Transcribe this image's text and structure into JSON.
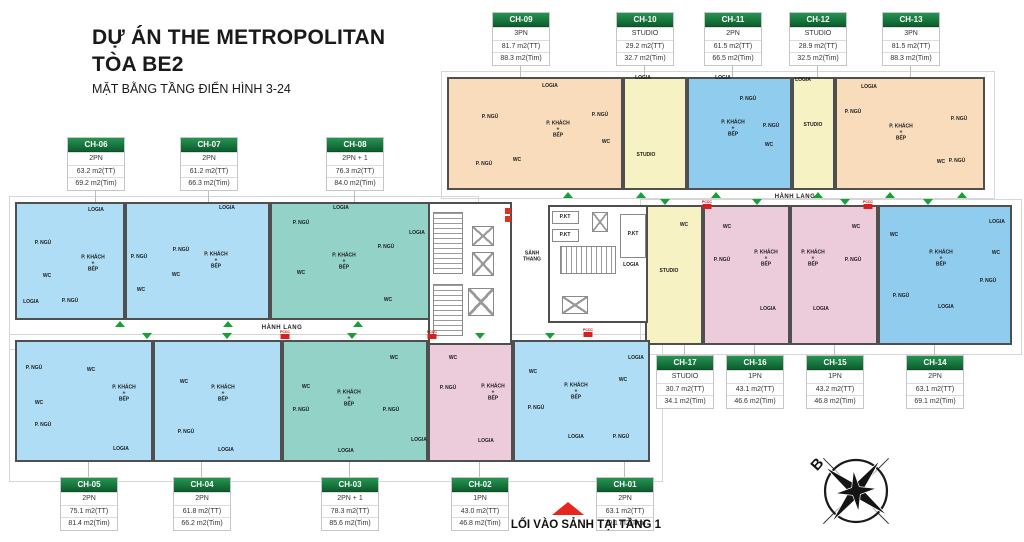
{
  "title": {
    "line1": "DỰ ÁN THE METROPOLITAN",
    "line2": "TÒA BE2",
    "subtitle": "MẶT BẰNG TẦNG ĐIỂN HÌNH 3-24"
  },
  "labels": {
    "hanh_lang": "HÀNH LANG",
    "entrance": "LỐI VÀO SẢNH TẠI TẦNG 1",
    "north": "B",
    "pccc": "PCCC"
  },
  "colors": {
    "orange": "#f8dcbb",
    "yellow": "#f6f2c4",
    "blue": "#8fccee",
    "lightblue": "#aeddf5",
    "teal": "#93d2c7",
    "pink": "#ecccda",
    "wall": "#4f4f4f",
    "header_green": "#0d5e2e",
    "arrow_green": "#17a035",
    "entry_red": "#e8251f"
  },
  "cards": [
    {
      "code": "CH-09",
      "type": "3PN",
      "tt": "81.7 m2(TT)",
      "tim": "88.3 m2(Tim)",
      "x": 492,
      "y": 12
    },
    {
      "code": "CH-10",
      "type": "STUDIO",
      "tt": "29.2 m2(TT)",
      "tim": "32.7 m2(Tim)",
      "x": 616,
      "y": 12
    },
    {
      "code": "CH-11",
      "type": "2PN",
      "tt": "61.5 m2(TT)",
      "tim": "66.5 m2(Tim)",
      "x": 704,
      "y": 12
    },
    {
      "code": "CH-12",
      "type": "STUDIO",
      "tt": "28.9 m2(TT)",
      "tim": "32.5 m2(Tim)",
      "x": 789,
      "y": 12
    },
    {
      "code": "CH-13",
      "type": "3PN",
      "tt": "81.5 m2(TT)",
      "tim": "88.3 m2(Tim)",
      "x": 882,
      "y": 12
    },
    {
      "code": "CH-06",
      "type": "2PN",
      "tt": "63.2 m2(TT)",
      "tim": "69.2 m2(Tim)",
      "x": 67,
      "y": 137
    },
    {
      "code": "CH-07",
      "type": "2PN",
      "tt": "61.2 m2(TT)",
      "tim": "66.3 m2(Tim)",
      "x": 180,
      "y": 137
    },
    {
      "code": "CH-08",
      "type": "2PN + 1",
      "tt": "76.3 m2(TT)",
      "tim": "84.0 m2(Tim)",
      "x": 326,
      "y": 137
    },
    {
      "code": "CH-17",
      "type": "STUDIO",
      "tt": "30.7 m2(TT)",
      "tim": "34.1 m2(Tim)",
      "x": 656,
      "y": 355
    },
    {
      "code": "CH-16",
      "type": "1PN",
      "tt": "43.1 m2(TT)",
      "tim": "46.6 m2(Tim)",
      "x": 726,
      "y": 355
    },
    {
      "code": "CH-15",
      "type": "1PN",
      "tt": "43.2 m2(TT)",
      "tim": "46.8 m2(Tim)",
      "x": 806,
      "y": 355
    },
    {
      "code": "CH-14",
      "type": "2PN",
      "tt": "63.1 m2(TT)",
      "tim": "69.1 m2(Tim)",
      "x": 906,
      "y": 355
    },
    {
      "code": "CH-05",
      "type": "2PN",
      "tt": "75.1 m2(TT)",
      "tim": "81.4 m2(Tim)",
      "x": 60,
      "y": 477
    },
    {
      "code": "CH-04",
      "type": "2PN",
      "tt": "61.8 m2(TT)",
      "tim": "66.2 m2(Tim)",
      "x": 173,
      "y": 477
    },
    {
      "code": "CH-03",
      "type": "2PN + 1",
      "tt": "78.3 m2(TT)",
      "tim": "85.6 m2(Tim)",
      "x": 321,
      "y": 477
    },
    {
      "code": "CH-02",
      "type": "1PN",
      "tt": "43.0 m2(TT)",
      "tim": "46.8 m2(Tim)",
      "x": 451,
      "y": 477
    },
    {
      "code": "CH-01",
      "type": "2PN",
      "tt": "63.1 m2(TT)",
      "tim": "70.1 m2(Tim)",
      "x": 596,
      "y": 477
    }
  ],
  "units": [
    {
      "id": "CH-09",
      "c": "orange",
      "x": 447,
      "y": 77,
      "w": 176,
      "h": 113,
      "rooms": [
        [
          "P. NGỦ",
          490,
          118
        ],
        [
          "LOGIA",
          550,
          87
        ],
        [
          "P. NGỦ",
          484,
          165
        ],
        [
          "P. KHÁCH\n+\nBẾP",
          558,
          130
        ],
        [
          "WC",
          517,
          161
        ],
        [
          "P. NGỦ",
          600,
          116
        ],
        [
          "WC",
          606,
          143
        ]
      ]
    },
    {
      "id": "CH-10",
      "c": "yellow",
      "x": 623,
      "y": 77,
      "w": 64,
      "h": 113,
      "rooms": [
        [
          "LOGIA",
          643,
          79
        ],
        [
          "STUDIO",
          646,
          156
        ]
      ]
    },
    {
      "id": "CH-11",
      "c": "blue",
      "x": 687,
      "y": 77,
      "w": 105,
      "h": 113,
      "rooms": [
        [
          "LOGIA",
          723,
          79
        ],
        [
          "P. NGỦ",
          748,
          100
        ],
        [
          "P. KHÁCH\n+\nBẾP",
          733,
          129
        ],
        [
          "P. NGỦ",
          771,
          127
        ],
        [
          "WC",
          769,
          146
        ]
      ]
    },
    {
      "id": "CH-12",
      "c": "yellow",
      "x": 792,
      "y": 77,
      "w": 43,
      "h": 113,
      "rooms": [
        [
          "LOGIA",
          803,
          81
        ],
        [
          "STUDIO",
          813,
          126
        ]
      ]
    },
    {
      "id": "CH-13",
      "c": "orange",
      "x": 835,
      "y": 77,
      "w": 150,
      "h": 113,
      "rooms": [
        [
          "LOGIA",
          869,
          88
        ],
        [
          "P. NGỦ",
          853,
          113
        ],
        [
          "P. KHÁCH\n+\nBẾP",
          901,
          133
        ],
        [
          "P. NGỦ",
          959,
          120
        ],
        [
          "P. NGỦ",
          957,
          162
        ],
        [
          "WC",
          941,
          163
        ]
      ]
    },
    {
      "id": "CH-17",
      "c": "yellow",
      "x": 645,
      "y": 205,
      "w": 58,
      "h": 140,
      "rooms": [
        [
          "WC",
          684,
          226
        ],
        [
          "STUDIO",
          669,
          272
        ]
      ]
    },
    {
      "id": "CH-17-logia",
      "c": "yellow",
      "x": 616,
      "y": 238,
      "w": 29,
      "h": 57,
      "rooms": [
        [
          "LOGIA",
          631,
          266
        ]
      ]
    },
    {
      "id": "CH-16",
      "c": "pink",
      "x": 703,
      "y": 205,
      "w": 87,
      "h": 140,
      "rooms": [
        [
          "WC",
          727,
          228
        ],
        [
          "P. NGỦ",
          722,
          261
        ],
        [
          "P. KHÁCH\n+\nBẾP",
          766,
          259
        ],
        [
          "LOGIA",
          768,
          310
        ]
      ]
    },
    {
      "id": "CH-15",
      "c": "pink",
      "x": 790,
      "y": 205,
      "w": 88,
      "h": 140,
      "rooms": [
        [
          "WC",
          856,
          228
        ],
        [
          "P. NGỦ",
          853,
          261
        ],
        [
          "P. KHÁCH\n+\nBẾP",
          813,
          259
        ],
        [
          "LOGIA",
          821,
          310
        ]
      ]
    },
    {
      "id": "CH-14",
      "c": "blue",
      "x": 878,
      "y": 205,
      "w": 134,
      "h": 140,
      "rooms": [
        [
          "WC",
          894,
          236
        ],
        [
          "P. NGỦ",
          901,
          297
        ],
        [
          "P. KHÁCH\n+\nBẾP",
          941,
          259
        ],
        [
          "LOGIA",
          997,
          223
        ],
        [
          "WC",
          996,
          254
        ],
        [
          "P. NGỦ",
          988,
          282
        ],
        [
          "LOGIA",
          946,
          308
        ]
      ]
    },
    {
      "id": "CH-06",
      "c": "lightblue",
      "x": 15,
      "y": 202,
      "w": 110,
      "h": 118,
      "rooms": [
        [
          "P. NGỦ",
          43,
          244
        ],
        [
          "LOGIA",
          96,
          211
        ],
        [
          "WC",
          47,
          277
        ],
        [
          "P. KHÁCH\n+\nBẾP",
          93,
          264
        ],
        [
          "P. NGỦ",
          70,
          302
        ],
        [
          "LOGIA",
          31,
          303
        ]
      ]
    },
    {
      "id": "CH-07",
      "c": "lightblue",
      "x": 125,
      "y": 202,
      "w": 145,
      "h": 118,
      "rooms": [
        [
          "P. NGỦ",
          139,
          258
        ],
        [
          "P. NGỦ",
          181,
          251
        ],
        [
          "LOGIA",
          227,
          209
        ],
        [
          "WC",
          176,
          276
        ],
        [
          "WC",
          141,
          291
        ],
        [
          "P. KHÁCH\n+\nBẾP",
          216,
          261
        ]
      ]
    },
    {
      "id": "CH-08",
      "c": "teal",
      "x": 270,
      "y": 202,
      "w": 160,
      "h": 118,
      "rooms": [
        [
          "P. NGỦ",
          301,
          224
        ],
        [
          "LOGIA",
          341,
          209
        ],
        [
          "P. KHÁCH\n+\nBẾP",
          344,
          262
        ],
        [
          "P. NGỦ",
          386,
          248
        ],
        [
          "LOGIA",
          417,
          234
        ],
        [
          "WC",
          301,
          274
        ],
        [
          "WC",
          388,
          301
        ]
      ]
    },
    {
      "id": "CH-05",
      "c": "lightblue",
      "x": 15,
      "y": 340,
      "w": 138,
      "h": 122,
      "rooms": [
        [
          "P. NGỦ",
          34,
          369
        ],
        [
          "WC",
          91,
          371
        ],
        [
          "P. KHÁCH\n+\nBẾP",
          124,
          394
        ],
        [
          "WC",
          39,
          404
        ],
        [
          "P. NGỦ",
          43,
          426
        ],
        [
          "LOGIA",
          121,
          450
        ]
      ]
    },
    {
      "id": "CH-04",
      "c": "lightblue",
      "x": 153,
      "y": 340,
      "w": 129,
      "h": 122,
      "rooms": [
        [
          "WC",
          184,
          383
        ],
        [
          "P. KHÁCH\n+\nBẾP",
          223,
          394
        ],
        [
          "P. NGỦ",
          186,
          433
        ],
        [
          "LOGIA",
          226,
          451
        ]
      ]
    },
    {
      "id": "CH-03",
      "c": "teal",
      "x": 282,
      "y": 340,
      "w": 146,
      "h": 122,
      "rooms": [
        [
          "WC",
          306,
          388
        ],
        [
          "WC",
          394,
          359
        ],
        [
          "P. NGỦ",
          301,
          411
        ],
        [
          "P. KHÁCH\n+\nBẾP",
          349,
          399
        ],
        [
          "P. NGỦ",
          391,
          411
        ],
        [
          "LOGIA",
          346,
          452
        ],
        [
          "LOGIA",
          419,
          441
        ]
      ]
    },
    {
      "id": "CH-02",
      "c": "pink",
      "x": 428,
      "y": 340,
      "w": 85,
      "h": 122,
      "rooms": [
        [
          "WC",
          453,
          359
        ],
        [
          "P. NGỦ",
          448,
          389
        ],
        [
          "P. KHÁCH\n+\nBẾP",
          493,
          393
        ],
        [
          "LOGIA",
          486,
          442
        ]
      ]
    },
    {
      "id": "CH-01",
      "c": "lightblue",
      "x": 513,
      "y": 340,
      "w": 137,
      "h": 122,
      "rooms": [
        [
          "WC",
          533,
          373
        ],
        [
          "P. KHÁCH\n+\nBẾP",
          576,
          392
        ],
        [
          "WC",
          623,
          381
        ],
        [
          "P. NGỦ",
          536,
          409
        ],
        [
          "LOGIA",
          576,
          438
        ],
        [
          "P. NGỦ",
          621,
          438
        ],
        [
          "LOGIA",
          636,
          359
        ]
      ]
    }
  ],
  "core": {
    "blocks": [
      {
        "x": 428,
        "y": 202,
        "w": 84,
        "h": 143
      },
      {
        "x": 548,
        "y": 205,
        "w": 100,
        "h": 118
      }
    ],
    "boxes": [
      {
        "k": "stair-v",
        "x": 433,
        "y": 212,
        "w": 30,
        "h": 62
      },
      {
        "k": "elev",
        "x": 472,
        "y": 226,
        "w": 22,
        "h": 20
      },
      {
        "k": "elev",
        "x": 472,
        "y": 252,
        "w": 22,
        "h": 24
      },
      {
        "k": "elev",
        "x": 468,
        "y": 288,
        "w": 26,
        "h": 28
      },
      {
        "k": "stair-v",
        "x": 433,
        "y": 284,
        "w": 30,
        "h": 52
      },
      {
        "k": "roombox",
        "x": 552,
        "y": 211,
        "w": 27,
        "h": 13
      },
      {
        "k": "roombox",
        "x": 552,
        "y": 229,
        "w": 27,
        "h": 13
      },
      {
        "k": "elev",
        "x": 592,
        "y": 212,
        "w": 16,
        "h": 20
      },
      {
        "k": "roombox",
        "x": 620,
        "y": 214,
        "w": 26,
        "h": 44
      },
      {
        "k": "stair-h",
        "x": 560,
        "y": 246,
        "w": 56,
        "h": 28
      },
      {
        "k": "elev",
        "x": 562,
        "y": 296,
        "w": 26,
        "h": 18
      },
      {
        "k": "redbox",
        "x": 505,
        "y": 208,
        "w": 6,
        "h": 6
      },
      {
        "k": "redbox",
        "x": 505,
        "y": 216,
        "w": 6,
        "h": 6
      }
    ],
    "labels": [
      {
        "t": "SẢNH\nTHANG",
        "x": 532,
        "y": 257
      },
      {
        "t": "P.KT",
        "x": 565,
        "y": 218
      },
      {
        "t": "P.KT",
        "x": 565,
        "y": 236
      },
      {
        "t": "P.KT",
        "x": 633,
        "y": 235
      }
    ]
  },
  "halls": [
    {
      "x": 282,
      "y": 328
    },
    {
      "x": 795,
      "y": 197
    }
  ],
  "arrows": [
    {
      "d": "up",
      "x": 568,
      "y": 192
    },
    {
      "d": "up",
      "x": 641,
      "y": 192
    },
    {
      "d": "up",
      "x": 716,
      "y": 192
    },
    {
      "d": "up",
      "x": 818,
      "y": 192
    },
    {
      "d": "up",
      "x": 890,
      "y": 192
    },
    {
      "d": "up",
      "x": 962,
      "y": 192
    },
    {
      "d": "down",
      "x": 665,
      "y": 199
    },
    {
      "d": "down",
      "x": 757,
      "y": 199
    },
    {
      "d": "down",
      "x": 845,
      "y": 199
    },
    {
      "d": "down",
      "x": 928,
      "y": 199
    },
    {
      "d": "up",
      "x": 120,
      "y": 321
    },
    {
      "d": "up",
      "x": 228,
      "y": 321
    },
    {
      "d": "up",
      "x": 358,
      "y": 321
    },
    {
      "d": "down",
      "x": 147,
      "y": 333
    },
    {
      "d": "down",
      "x": 227,
      "y": 333
    },
    {
      "d": "down",
      "x": 352,
      "y": 333
    },
    {
      "d": "down",
      "x": 480,
      "y": 333
    },
    {
      "d": "down",
      "x": 550,
      "y": 333
    }
  ],
  "pccc": [
    {
      "x": 285,
      "y": 334
    },
    {
      "x": 432,
      "y": 334
    },
    {
      "x": 588,
      "y": 332
    },
    {
      "x": 707,
      "y": 204
    },
    {
      "x": 868,
      "y": 204
    }
  ],
  "connectors": [
    {
      "x": 520,
      "y1": 61,
      "y2": 77
    },
    {
      "x": 644,
      "y1": 61,
      "y2": 77
    },
    {
      "x": 732,
      "y1": 61,
      "y2": 77
    },
    {
      "x": 817,
      "y1": 61,
      "y2": 77
    },
    {
      "x": 910,
      "y1": 61,
      "y2": 77
    },
    {
      "x": 95,
      "y1": 186,
      "y2": 202
    },
    {
      "x": 208,
      "y1": 186,
      "y2": 202
    },
    {
      "x": 354,
      "y1": 186,
      "y2": 202
    },
    {
      "x": 684,
      "y1": 345,
      "y2": 355
    },
    {
      "x": 754,
      "y1": 345,
      "y2": 355
    },
    {
      "x": 834,
      "y1": 345,
      "y2": 355
    },
    {
      "x": 934,
      "y1": 345,
      "y2": 355
    },
    {
      "x": 88,
      "y1": 462,
      "y2": 477
    },
    {
      "x": 201,
      "y1": 462,
      "y2": 477
    },
    {
      "x": 349,
      "y1": 462,
      "y2": 477
    },
    {
      "x": 479,
      "y1": 462,
      "y2": 477
    },
    {
      "x": 624,
      "y1": 462,
      "y2": 477
    }
  ],
  "outlines": [
    {
      "x": 441,
      "y": 71,
      "w": 552,
      "h": 126
    },
    {
      "x": 9,
      "y": 196,
      "w": 468,
      "h": 152
    },
    {
      "x": 9,
      "y": 334,
      "w": 652,
      "h": 146
    },
    {
      "x": 640,
      "y": 199,
      "w": 380,
      "h": 154
    }
  ]
}
